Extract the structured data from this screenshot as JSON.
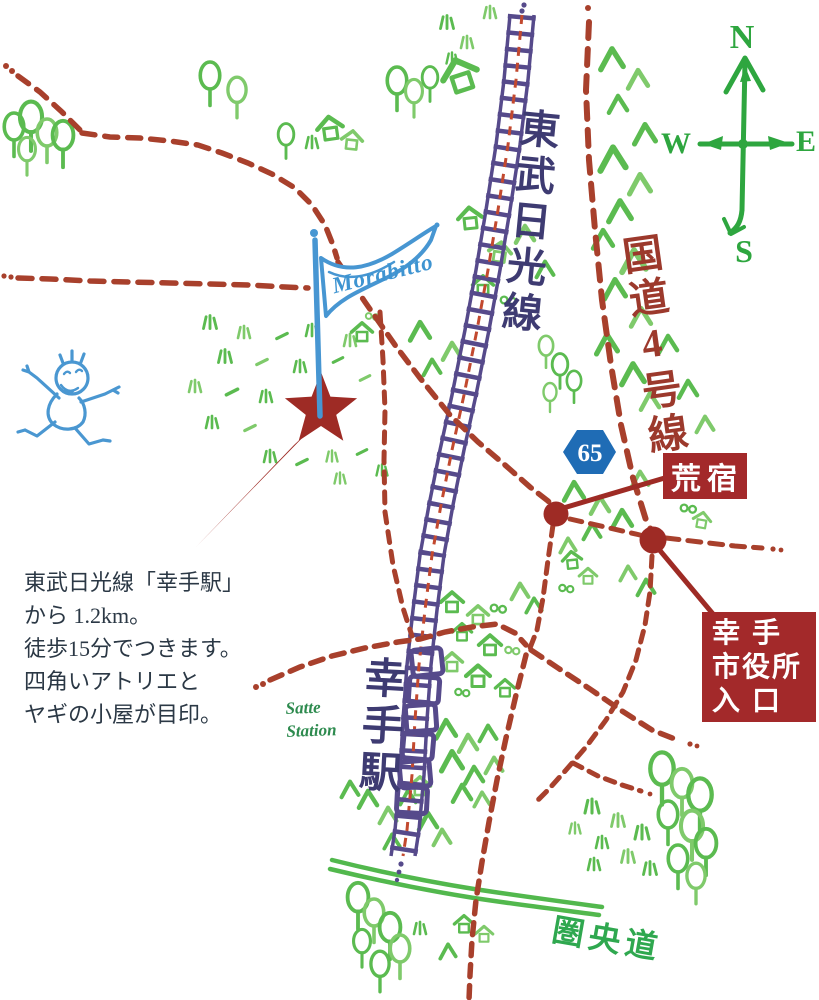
{
  "map": {
    "flag_name": "Morabitto",
    "railway_label": "東武日光線",
    "route4_label": "国道4号線",
    "route_shield": "65",
    "station_label_jp": "幸手駅",
    "station_label_en": [
      "Satte",
      "Station"
    ],
    "expressway_label": "圏央道",
    "landmark_arajuku": "荒宿",
    "cityhall_lines": [
      "幸手",
      "市役所",
      "入口"
    ],
    "compass": {
      "n": "N",
      "e": "E",
      "s": "S",
      "w": "W"
    },
    "note_lines": [
      "東武日光線「幸手駅」",
      "から 1.2km。",
      "徒歩15分でつきます。",
      "四角いアトリエと",
      "ヤギの小屋が目印。"
    ],
    "colors": {
      "road_red": "#a8402c",
      "accent_red": "#9e2b25",
      "label_box_red": "#a3292a",
      "railway_purple": "#564a8b",
      "text_indigo": "#3e3b72",
      "vegetation_green": "#5bbb50",
      "expressway_green": "#52b84d",
      "compass_green": "#2ea63f",
      "flag_blue": "#4796d2",
      "shield_blue": "#1f6cb5",
      "note_text": "#2b3845"
    }
  }
}
